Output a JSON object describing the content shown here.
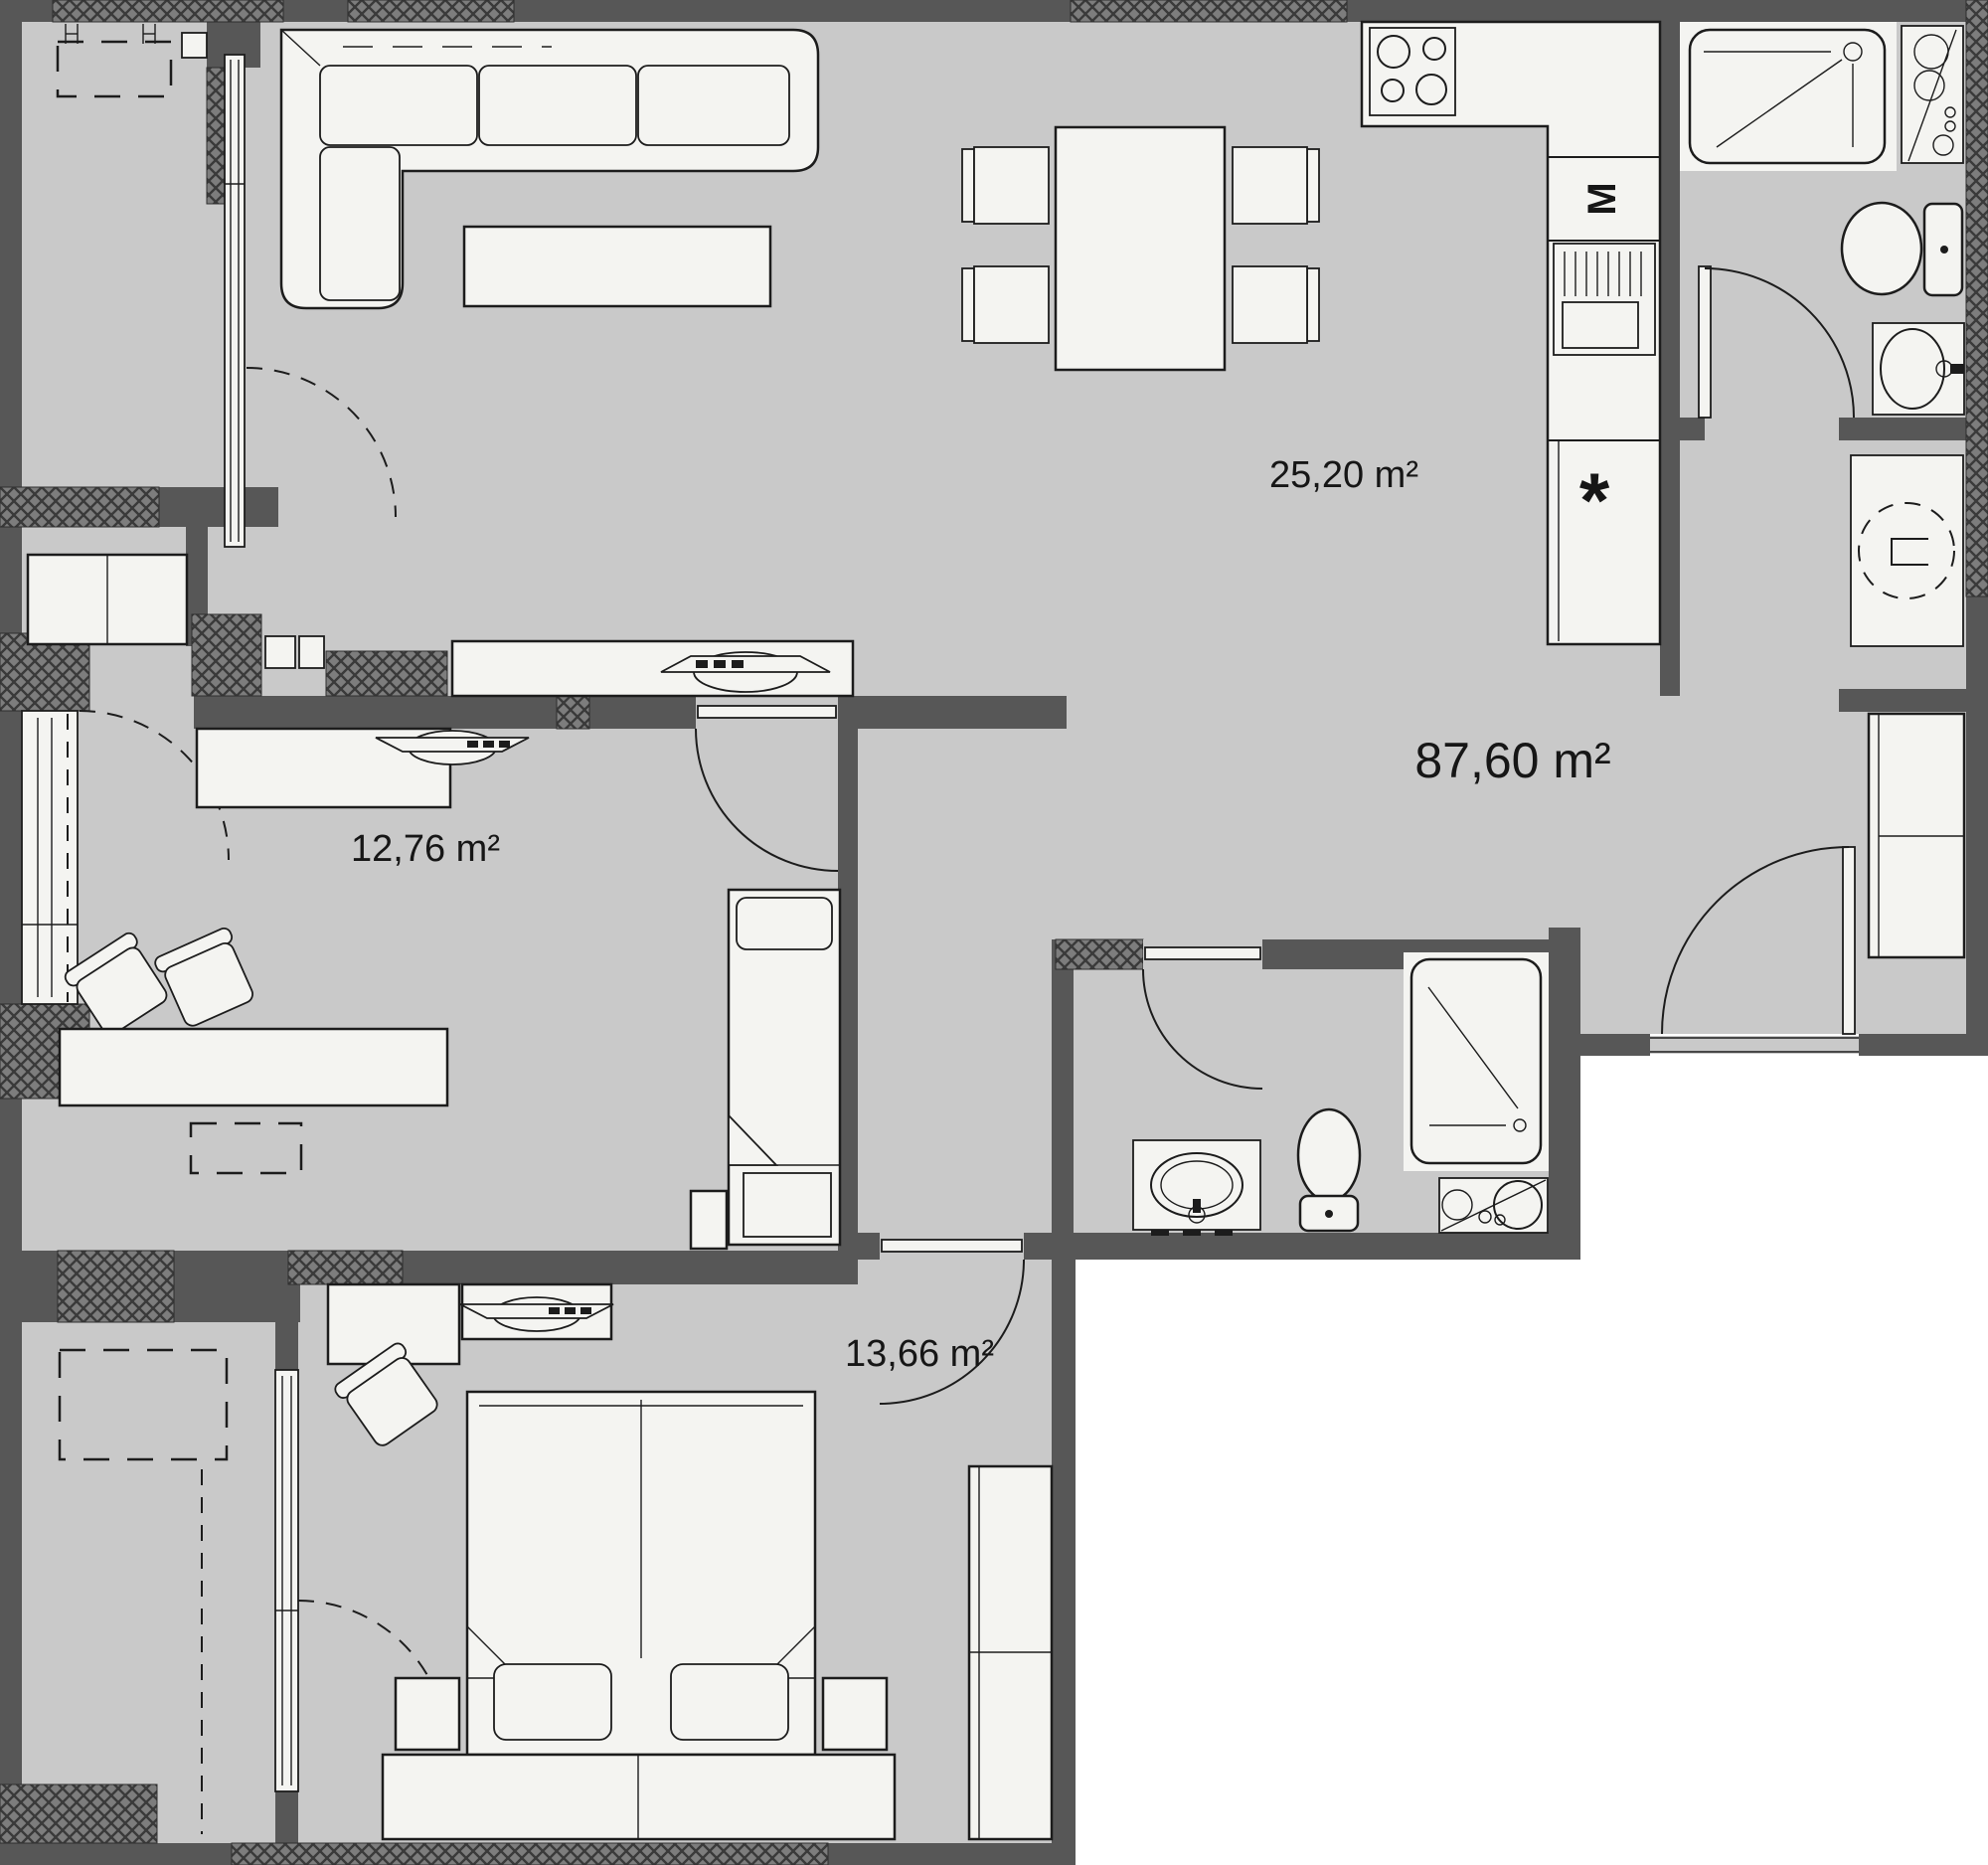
{
  "plan": {
    "type": "apartment-floor-plan",
    "colors": {
      "wall": "#575757",
      "floor": "#c9c9c9",
      "furniture": "#f4f4f1",
      "outline": "#1c1c1c",
      "outside": "#ffffff"
    },
    "rooms": [
      {
        "id": "living-dining-kitchen",
        "area_label": "25,20 m²"
      },
      {
        "id": "bedroom-1",
        "area_label": "12,76 m²"
      },
      {
        "id": "bedroom-2",
        "area_label": "13,66 m²"
      },
      {
        "id": "total-apartment",
        "area_label": "87,60 m²"
      }
    ],
    "appliances": {
      "microwave_label": "M",
      "fridge_label": "*"
    }
  }
}
